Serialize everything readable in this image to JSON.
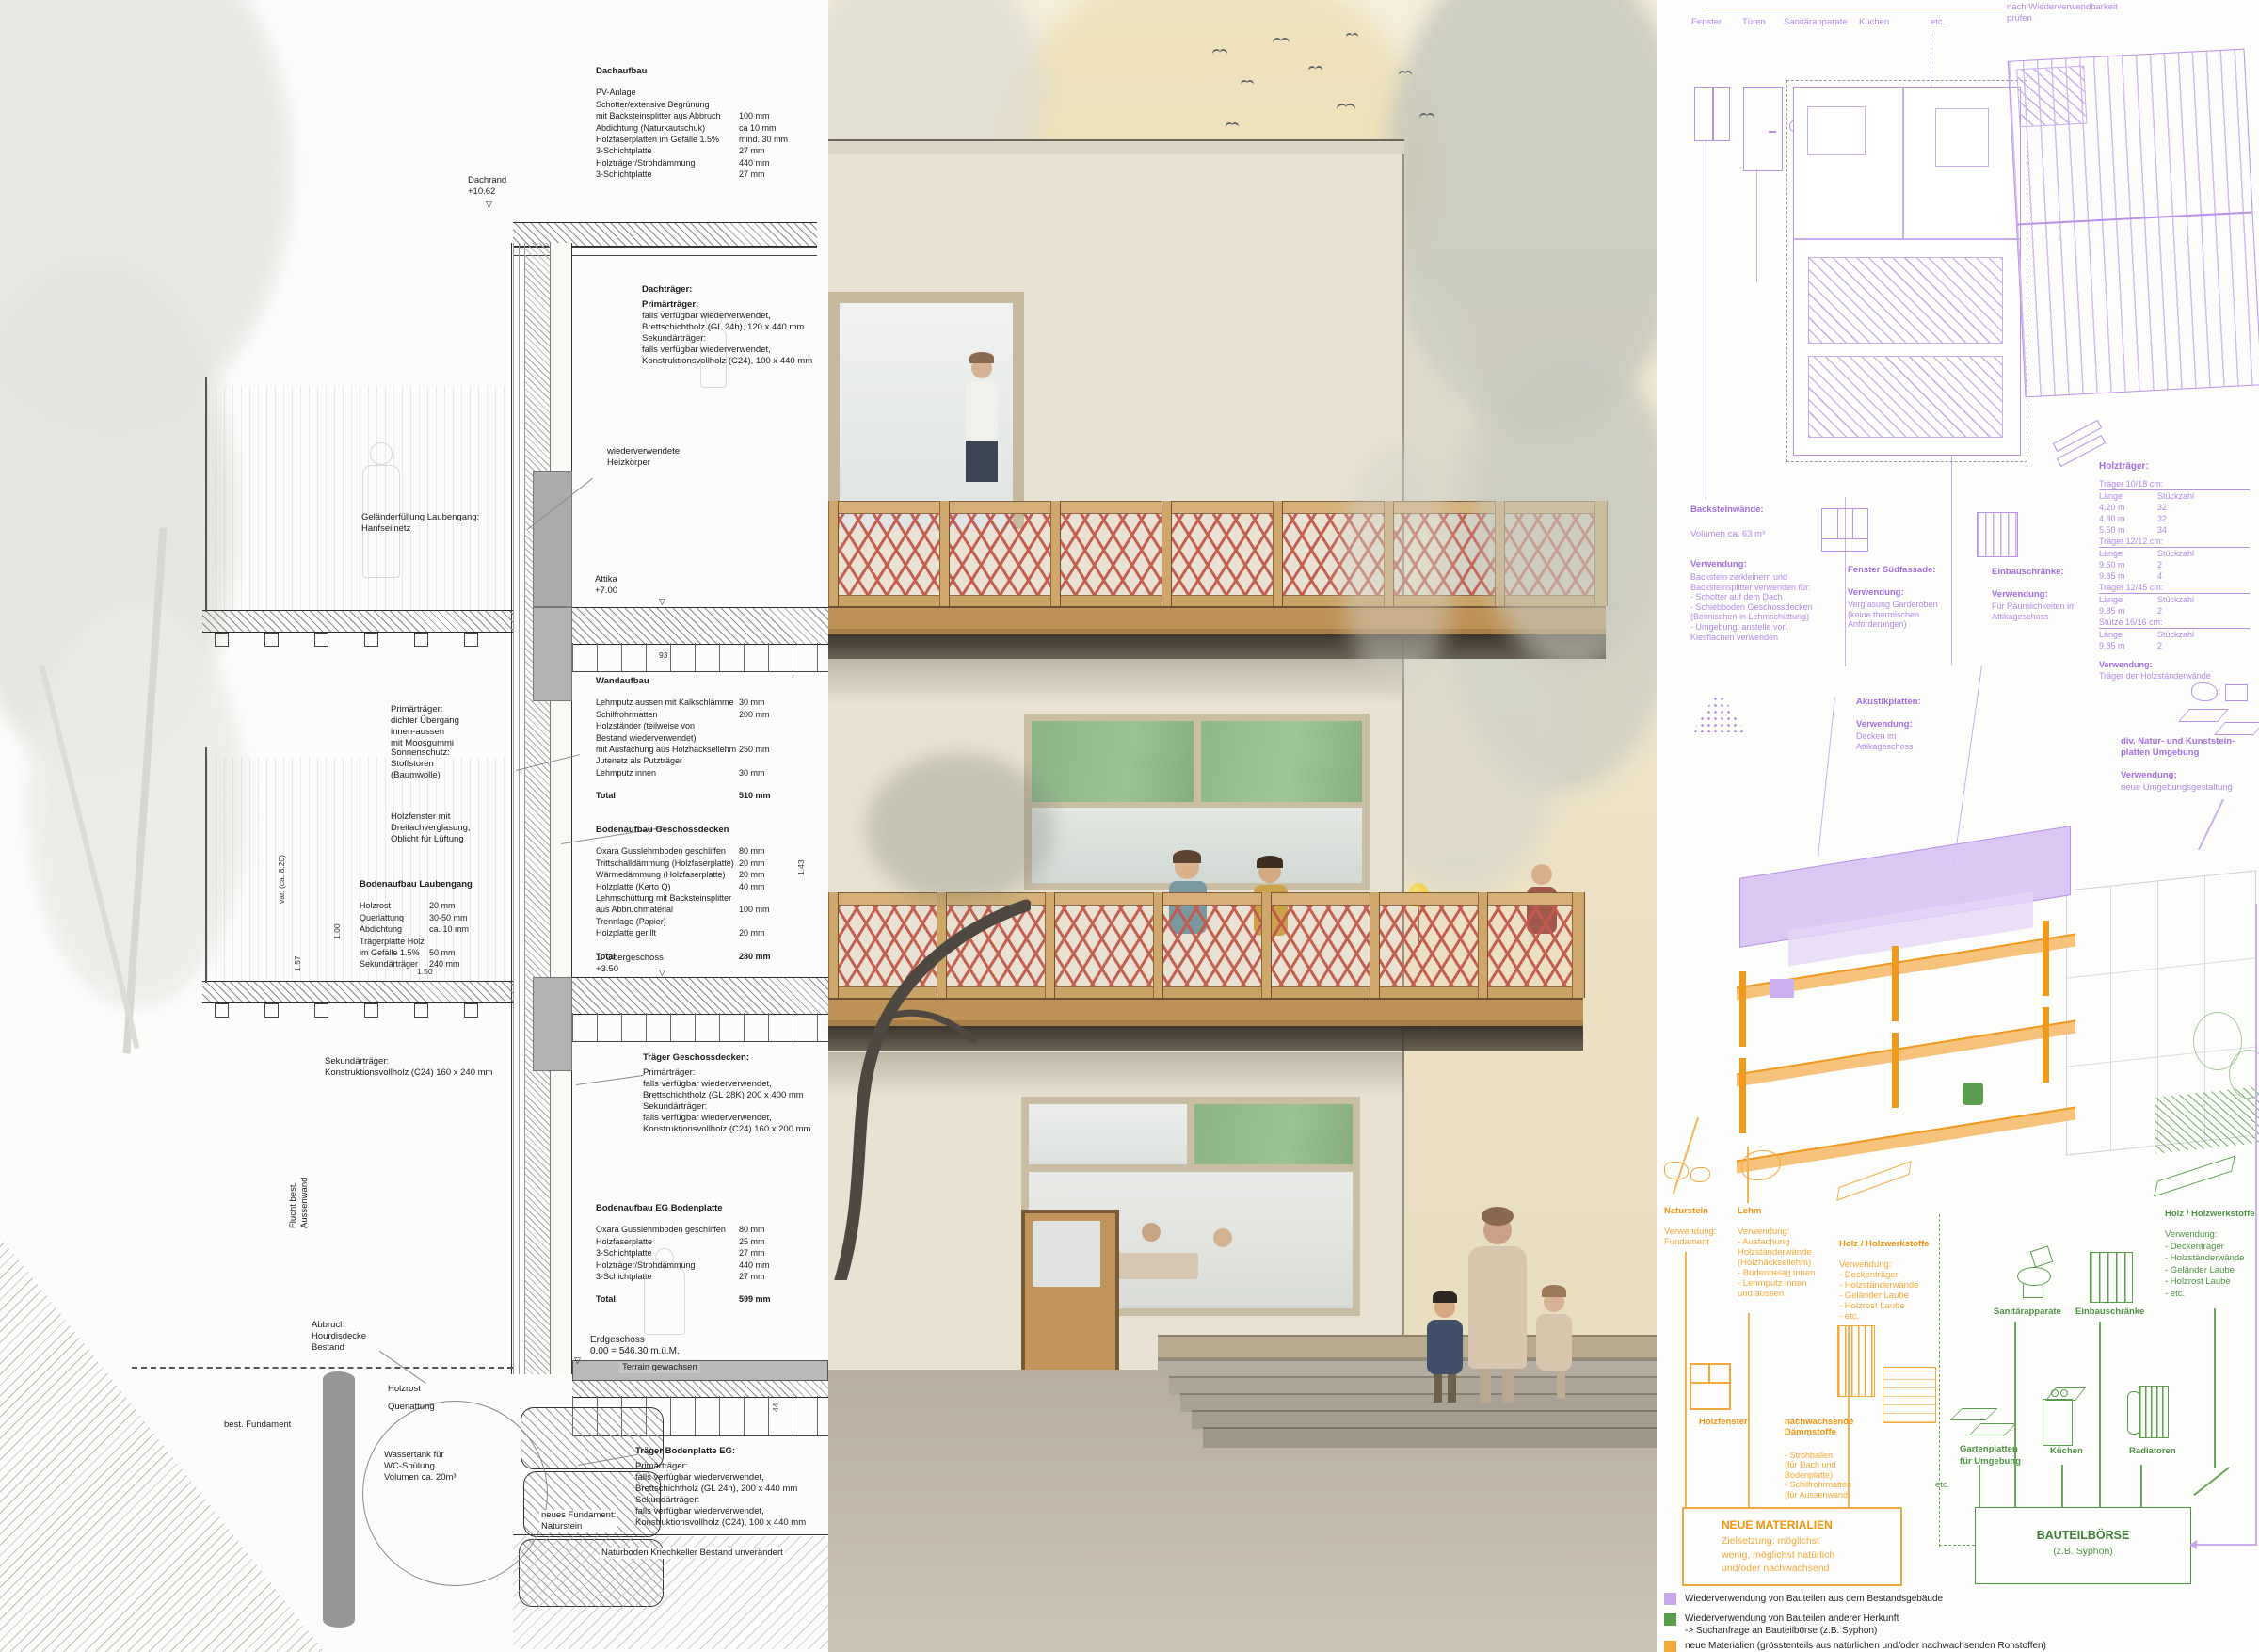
{
  "colors": {
    "purple_accent": "#a87fe0",
    "purple_line": "#c9aef0",
    "green_accent": "#4f9143",
    "orange_accent": "#f5a83a",
    "orange_dark": "#ef9410",
    "lattice_red": "#c4584a",
    "wood": "#cfa76a",
    "window_green": "#8cb487",
    "legend_purple": "#c9a8ec",
    "legend_green": "#5a9e4d",
    "legend_orange": "#f5a83a"
  },
  "left": {
    "dachaufbau": {
      "title": "Dachaufbau",
      "rows": [
        [
          "PV-Anlage",
          ""
        ],
        [
          "Schotter/extensive Begrünung",
          ""
        ],
        [
          "mit Backsteinsplitter aus Abbruch",
          "100 mm"
        ],
        [
          "Abdichtung (Naturkautschuk)",
          "ca 10 mm"
        ],
        [
          "Holzfaserplatten im Gefälle 1.5%",
          "mind. 30 mm"
        ],
        [
          "3-Schichtplatte",
          "27 mm"
        ],
        [
          "Holzträger/Strohdämmung",
          "440 mm"
        ],
        [
          "3-Schichtplatte",
          "27 mm"
        ]
      ]
    },
    "dachtraeger": {
      "title": "Dachträger:",
      "lines": [
        "Primärträger:",
        "falls verfügbar wiederverwendet,",
        "Brettschichtholz (GL 24h), 120 x 440 mm",
        "Sekundärträger:",
        "falls verfügbar wiederverwendet,",
        "Konstruktionsvollholz (C24), 100 x 440 mm"
      ]
    },
    "heizkoerper": [
      "wiederverwendete",
      "Heizkörper"
    ],
    "gelaender": [
      "Geländerfüllung Laubengang:",
      "Hanfseilnetz"
    ],
    "levels": {
      "dachrand": [
        "Dachrand",
        "+10.62"
      ],
      "attika": [
        "Attika",
        "+7.00"
      ],
      "og": [
        "1. Obergeschoss",
        "+3.50"
      ],
      "eg": [
        "Erdgeschoss",
        "0.00 = 546.30 m.ü.M."
      ]
    },
    "primaer_callout": [
      "Primärträger:",
      "dichter Übergang",
      "innen-aussen",
      "mit Moosgummi"
    ],
    "sonnenschutz": [
      "Sonnenschutz:",
      "Stoffstoren",
      "(Baumwolle)"
    ],
    "holzfenster": [
      "Holzfenster mit",
      "Dreifachverglasung,",
      "Oblicht für Lüftung"
    ],
    "wandaufbau": {
      "title": "Wandaufbau",
      "rows": [
        [
          "Lehmputz aussen mit Kalkschlämme",
          "30 mm"
        ],
        [
          "Schilfrohrmatten",
          "200 mm"
        ],
        [
          "Holzständer (teilweise von",
          ""
        ],
        [
          "Bestand wiederverwendet)",
          ""
        ],
        [
          "mit Ausfachung aus Holzhäcksellehm",
          "250 mm"
        ],
        [
          "Jutenetz als Putzträger",
          ""
        ],
        [
          "Lehmputz innen",
          "30 mm"
        ]
      ],
      "total_label": "Total",
      "total": "510 mm"
    },
    "geschossdecken": {
      "title": "Bodenaufbau Geschossdecken",
      "rows": [
        [
          "Oxara Gusslehmboden geschliffen",
          "80 mm"
        ],
        [
          "Trittschalldämmung (Holzfaserplatte)",
          "20 mm"
        ],
        [
          "Wärmedämmung (Holzfaserplatte)",
          "20 mm"
        ],
        [
          "Holzplatte (Kerto Q)",
          "40 mm"
        ],
        [
          "Lehmschüttung mit Backsteinsplitter",
          ""
        ],
        [
          "aus Abbruchmaterial",
          "100 mm"
        ],
        [
          "Trennlage (Papier)",
          ""
        ],
        [
          "Holzplatte gerillt",
          "20 mm"
        ]
      ],
      "total_label": "Total",
      "total": "280 mm"
    },
    "laubengang": {
      "title": "Bodenaufbau Laubengang",
      "rows": [
        [
          "Holzrost",
          "20 mm"
        ],
        [
          "Querlattung",
          "30-50 mm"
        ],
        [
          "Abdichtung",
          "ca. 10 mm"
        ],
        [
          "Trägerplatte Holz",
          ""
        ],
        [
          "im Gefälle 1.5%",
          "50 mm"
        ],
        [
          "Sekundärträger",
          "240 mm"
        ]
      ]
    },
    "sekundaer_callout": [
      "Sekundärträger:",
      "Konstruktionsvollholz (C24)  160 x 240 mm"
    ],
    "traeger_decken": {
      "title": "Träger Geschossdecken:",
      "lines": [
        "Primärträger:",
        "falls verfügbar wiederverwendet,",
        "Brettschichtholz (GL 28K) 200 x 400 mm",
        "Sekundärträger:",
        "falls verfügbar wiederverwendet,",
        "Konstruktionsvollholz (C24) 160 x 200 mm"
      ]
    },
    "eg_bodenplatte": {
      "title": "Bodenaufbau EG Bodenplatte",
      "rows": [
        [
          "Oxara Gusslehmboden geschliffen",
          "80 mm"
        ],
        [
          "Holzfaserplatte",
          "25 mm"
        ],
        [
          "3-Schichtplatte",
          "27 mm"
        ],
        [
          "Holzträger/Strohdämmung",
          "440 mm"
        ],
        [
          "3-Schichtplatte",
          "27 mm"
        ]
      ],
      "total_label": "Total",
      "total": "599 mm"
    },
    "flucht": [
      "Flucht best.",
      "Aussenwand"
    ],
    "abbruch": [
      "Abbruch",
      "Hourdisdecke",
      "Bestand"
    ],
    "holzrost": "Holzrost",
    "querlattung": "Querlattung",
    "fundament": "best. Fundament",
    "wassertank": [
      "Wassertank für",
      "WC-Spülung",
      "Volumen ca. 20m³"
    ],
    "neues_fundament": [
      "neues Fundament:",
      "Naturstein"
    ],
    "terrain": "Terrain gewachsen",
    "traeger_bodenplatte": {
      "title": "Träger Bodenplatte EG:",
      "lines": [
        "Primärträger:",
        "falls verfügbar wiederverwendet,",
        "Brettschichtholz (GL 24h), 200 x 440 mm",
        "Sekundärträger:",
        "falls verfügbar wiederverwendet,",
        "Konstruktionsvollholz (C24), 100 x 440 mm"
      ]
    },
    "naturboden": "Naturboden Kriechkeller Bestand unverändert",
    "dims": {
      "d150": "1.50",
      "d100": "1.00",
      "d157": "1.57",
      "dvar": "var. (ca. 8.20)",
      "d44": "44",
      "d143": "1.43",
      "d93": "93"
    }
  },
  "right": {
    "top_items": [
      "Fenster",
      "Türen",
      "Sanitärapparate",
      "Küchen",
      "etc."
    ],
    "top_note": [
      "nach Wiederverwendbarkeit",
      "prüfen"
    ],
    "backstein": {
      "title": "Backsteinwände:",
      "volumen": "Volumen ca. 63 m³",
      "verwendung": "Verwendung:",
      "lines": [
        "Backstein zerkleinern und",
        "Backsteinsplitter verwenden für:",
        "- Schotter auf dem Dach",
        "- Schiebboden Geschossdecken",
        "(Beimischen in Lehmschüttung)",
        "- Umgebung: anstelle von",
        "Kiesflächen verwenden"
      ]
    },
    "fenster_sued": {
      "title": "Fenster Südfassade:",
      "verwendung": "Verwendung:",
      "lines": [
        "Verglasung Garderoben",
        "(keine thermischen",
        "Anforderungen)"
      ]
    },
    "einbau": {
      "title": "Einbauschränke:",
      "verwendung": "Verwendung:",
      "lines": [
        "Für Räumlichkeiten im",
        "Attikageschoss"
      ]
    },
    "akustik": {
      "title": "Akustikplatten:",
      "verwendung": "Verwendung:",
      "lines": [
        "Decken im",
        "Attikageschoss"
      ]
    },
    "holztraeger": {
      "title": "Holzträger:",
      "col1": "Länge",
      "col2": "Stückzahl",
      "g1": {
        "head": "Träger 10/18 cm:",
        "rows": [
          [
            "4.20 m",
            "32"
          ],
          [
            "4.80 m",
            "32"
          ],
          [
            "5.50 m",
            "34"
          ]
        ]
      },
      "g2": {
        "head": "Träger 12/12 cm:",
        "rows": [
          [
            "9.50 m",
            "2"
          ],
          [
            "9.85 m",
            "4"
          ]
        ]
      },
      "g3": {
        "head": "Träger 12/45 cm:",
        "rows": [
          [
            "9.85 m",
            "2"
          ]
        ]
      },
      "g4": {
        "head": "Stütze 16/16 cm:",
        "rows": [
          [
            "9.85 m",
            "2"
          ]
        ]
      },
      "verwendung": "Verwendung:",
      "use": "Träger der Holzständerwände"
    },
    "natursteinplatten": {
      "title": [
        "div. Natur- und Kunststein-",
        "platten Umgebung"
      ],
      "verwendung": "Verwendung:",
      "use": "neue Umgebungsgestaltung"
    },
    "o_naturstein": {
      "title": "Naturstein",
      "lines": [
        "Verwendung:",
        "Fundament"
      ]
    },
    "o_lehm": {
      "title": "Lehm",
      "lines": [
        "Verwendung:",
        "- Ausfachung",
        "Holzständerwände",
        "(Holzhäcksellehm)",
        "- Bodenbelag innen",
        "- Lehmputz innen",
        "und aussen"
      ]
    },
    "o_holz": {
      "title": "Holz / Holzwerkstoffe",
      "lines": [
        "Verwendung:",
        "- Deckenträger",
        "- Holzständerwände",
        "- Geländer Laube",
        "- Holzrost Laube",
        "- etc."
      ]
    },
    "o_holzfenster": "Holzfenster",
    "o_daemm": {
      "title": [
        "nachwachsende",
        "Dämmstoffe"
      ],
      "lines": [
        "- Strohballen",
        "(für Dach und",
        "Bodenplatte)",
        "- Schilfrohrmatten",
        "(für Aussenwand)"
      ]
    },
    "neue_box": {
      "title": "NEUE MATERIALIEN",
      "lines": [
        "Zielsetzung: möglichst",
        "wenig, möglichst natürlich",
        "und/oder nachwachsend"
      ]
    },
    "g_sanitaer": "Sanitärapparate",
    "g_einbau": "Einbauschränke",
    "g_holz": {
      "title": "Holz / Holzwerkstoffe",
      "lines": [
        "Verwendung:",
        "- Deckenträger",
        "- Holzständerwände",
        "- Geländer Laube",
        "- Holzrost Laube",
        "- etc."
      ]
    },
    "g_garten": [
      "Gartenplatten",
      "für Umgebung"
    ],
    "g_kuechen": "Küchen",
    "g_radiatoren": "Radiatoren",
    "g_etc": "etc.",
    "boerse": {
      "title": "BAUTEILBÖRSE",
      "sub": "(z.B. Syphon)"
    },
    "legend": [
      {
        "label": [
          "Wiederverwendung von Bauteilen aus dem Bestandsgebäude"
        ]
      },
      {
        "label": [
          "Wiederverwendung von Bauteilen anderer Herkunft",
          "-> Suchanfrage an Bauteilbörse (z.B. Syphon)"
        ]
      },
      {
        "label": [
          "neue Materialien (grösstenteils aus natürlichen und/oder nachwachsenden Rohstoffen)"
        ]
      }
    ]
  }
}
